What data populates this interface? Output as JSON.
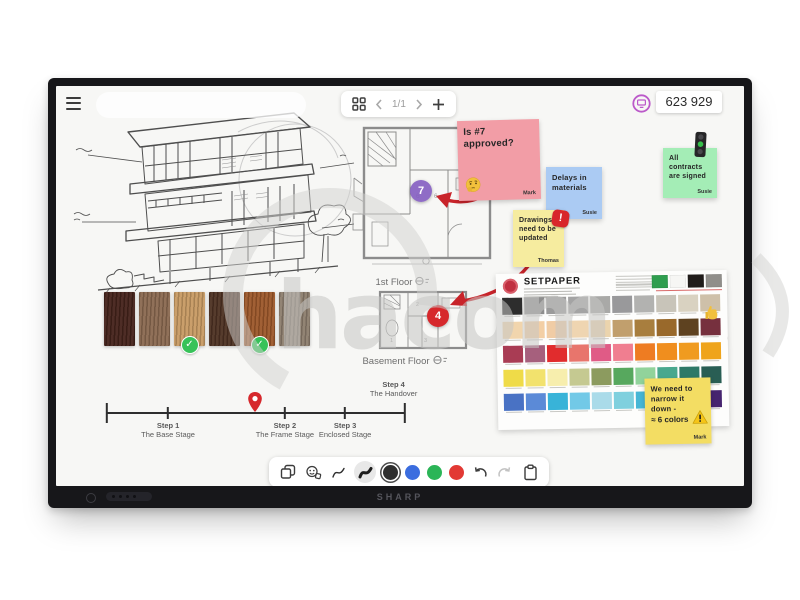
{
  "device": {
    "brand": "SHARP"
  },
  "topbar": {
    "page_indicator": "1/1",
    "session_code": "623 929"
  },
  "stickies": {
    "approved": {
      "text": "Is #7 approved?",
      "author": "Mark",
      "color": "#f29da6"
    },
    "delays": {
      "text": "Delays in materials",
      "author": "Susie",
      "color": "#abcbf3"
    },
    "drawings": {
      "text": "Drawings need to be updated",
      "author": "Thomas",
      "color": "#f6ec9f"
    },
    "contracts": {
      "text": "All contracts are signed",
      "author": "Susie",
      "color": "#a4edb6"
    },
    "narrow": {
      "text": "We need to narrow it down -",
      "amount": "≈ 6 colors",
      "author": "Mark",
      "color": "#f3dd63"
    }
  },
  "floorplans": {
    "first": {
      "label": "1st Floor",
      "marker": "7",
      "room_numbers": [
        "6",
        "6"
      ]
    },
    "basement": {
      "label": "Basement Floor",
      "marker": "4",
      "room_numbers": [
        "1",
        "2",
        "3"
      ]
    }
  },
  "timeline": {
    "ticks": [
      0,
      20.5,
      59.7,
      79.9,
      100
    ],
    "pin_pct": 49.7,
    "steps": [
      {
        "title": "Step 1",
        "subtitle": "The Base Stage",
        "pct": 20.5
      },
      {
        "title": "Step 2",
        "subtitle": "The Frame Stage",
        "pct": 59.7
      },
      {
        "title": "Step 3",
        "subtitle": "Enclosed Stage",
        "pct": 79.9
      },
      {
        "title": "Step 4",
        "subtitle": "The Handover",
        "pct": 100,
        "above": true
      }
    ]
  },
  "wood": {
    "colors": [
      "#44221a",
      "#8a6950",
      "#c79a63",
      "#4d3122",
      "#9c572a",
      "#8c7d6d"
    ],
    "approved": [
      2,
      4
    ]
  },
  "palette": {
    "title": "SETPAPER",
    "header_swatches": [
      "#2f9e4f",
      "#f6f6f4",
      "#201c1a",
      "#908e8a"
    ],
    "rows": [
      [
        "#2d2d2d",
        "#8e8e8e",
        "#9b9b9b",
        "#a4a4a4",
        "#a9a9a7",
        "#99999b",
        "#b2b2b0",
        "#c8c4b9",
        "#d9d2c1",
        "#cec0a9"
      ],
      [
        "#f1d5ad",
        "#f3cfa5",
        "#f0cca5",
        "#efd5b1",
        "#ebd4ad",
        "#c19f6d",
        "#a87e3e",
        "#99692b",
        "#5e4220",
        "#76303e"
      ],
      [
        "#a93c54",
        "#a6607d",
        "#e12c2d",
        "#e8756c",
        "#e05b86",
        "#f07e90",
        "#ee7c22",
        "#f08e1e",
        "#f09b1f",
        "#efa41b"
      ],
      [
        "#efdb48",
        "#f2e26d",
        "#f7eead",
        "#c5c991",
        "#8c9b5f",
        "#57a85e",
        "#91d39b",
        "#49a88e",
        "#2e7967",
        "#295e54"
      ],
      [
        "#4972c4",
        "#5b8ad7",
        "#38b3d8",
        "#72c9e7",
        "#aadbe9",
        "#7fd0de",
        "#46b6d5",
        "#399cc2",
        "#693c99",
        "#46246f"
      ]
    ]
  },
  "toolbar": {
    "pen_colors": [
      "#2f2f2f",
      "#3b6ddf",
      "#2bb557",
      "#e23934"
    ]
  },
  "watermark": {
    "text": "hacom"
  }
}
